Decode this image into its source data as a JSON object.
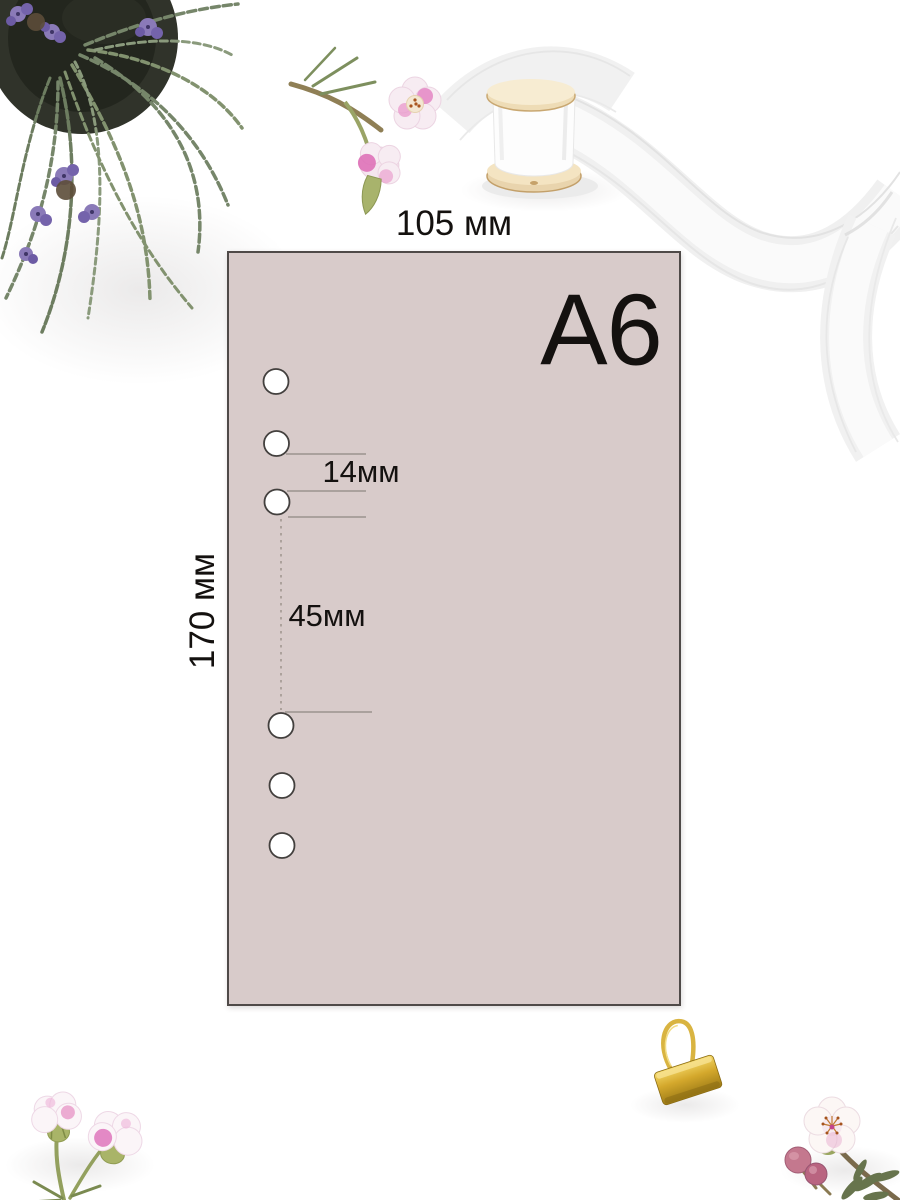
{
  "labels": {
    "size": "A6",
    "width": "105 мм",
    "height": "170 мм",
    "hole_spacing": "14мм",
    "group_gap": "45мм"
  },
  "sheet": {
    "paper_color": "#d8cbca",
    "border_color": "#4f4a48",
    "hole_count": 6,
    "hole_groups": 2,
    "holes_per_group": 3
  },
  "decor": {
    "items": [
      "potted-rosemary-plant",
      "wax-flower-sprig-top",
      "white-ribbon-spool",
      "gold-binder-clip",
      "wax-flowers-bottom-left",
      "wax-flower-bottom-right"
    ],
    "accent_gold": "#d4a82c",
    "flower_pink": "#e27fc0",
    "foliage_green": "#7e8d6f",
    "lavender_purple": "#8a7ab8",
    "ribbon_white": "#f2f2f2"
  }
}
